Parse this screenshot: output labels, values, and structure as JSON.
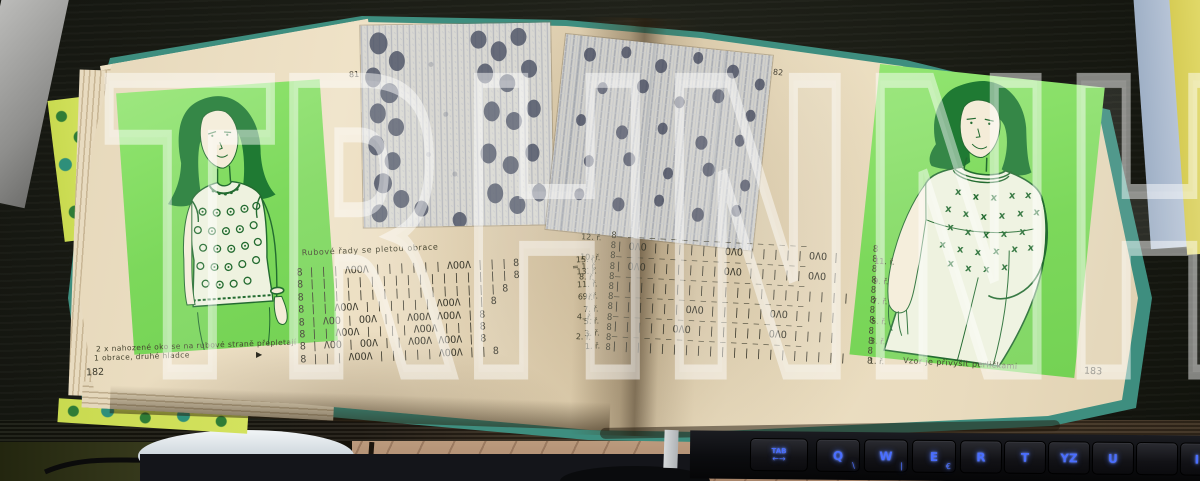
{
  "watermark": {
    "text": "TRHNNH"
  },
  "book": {
    "left_page": {
      "photo_label": "81",
      "chart_note": "Rubové řady se pletou obrace",
      "chart": {
        "rows": [
          {
            "symbols": "8 | | | ΛOOΛ | | | | | | ΛOOΛ | | | 8",
            "label": "15. ř.",
            "label2": "= 1. ř."
          },
          {
            "symbols": "8 | | | | | | | | | | | | | | | | | 8",
            "label": "13. ř."
          },
          {
            "symbols": "8 | | | | | | | | | | | | | | | | 8",
            "label": "11. ř."
          },
          {
            "symbols": "8 | | ΛOOΛ | | | | | | ΛOOΛ | | 8",
            "label": "9. ř."
          },
          {
            "symbols": "8 | ΛOO | OOΛ | | ΛOOΛ ΛOOΛ | 8",
            "label": "7. ř."
          },
          {
            "symbols": "8 | | ΛOOΛ | | | | ΛOOΛ | | | 8",
            "label": "5. ř."
          },
          {
            "symbols": "8 | ΛOO | OOΛ | | ΛOOΛ ΛOOΛ | 8",
            "label": "3. ř."
          },
          {
            "symbols": "8 | | | ΛOOΛ | | | | | ΛOOΛ | | 8",
            "label": "1. ř."
          }
        ]
      },
      "caption_line1": "2 x nahozené oko se na rubové straně přepletají",
      "caption_line2": "1 obrace, druhé hladce",
      "pointer": "▶",
      "page_number": "182"
    },
    "right_page": {
      "photo_label": "82",
      "chart": {
        "edge": "8\n8\n8\n8\n8\n8\n8\n8\n8\n8\n8\n8",
        "rows": [
          {
            "left": "12. ř.",
            "dash": "– – – – – – – – – – – – – – – – – –",
            "symbols": "| OΛO | | | | | | OΛO | | | | | OΛO |",
            "right": "11. ř."
          },
          {
            "left": "10. ř.",
            "dash": "– – – – – – – – – – – – – – – – – –",
            "symbols": "| OΛO | | | | | | OΛO | | | | | OΛO |",
            "right": "9. ř."
          },
          {
            "left": "8. ř.",
            "dash": "– – – – – – – – – – – – – – – – – –",
            "symbols": "| | | | | | | | | | | | | | | | | | | |",
            "right": "7. ř."
          },
          {
            "left": "6. ř.",
            "dash": "– – – – – – – – – – – – – – – – – –",
            "symbols": "| | | | | | OΛO | | | | | OΛO | | | |",
            "right": "5. ř."
          },
          {
            "left": "4. ř.",
            "dash": "– – – – – – – – – – – – – – – – – –",
            "symbols": "| | | | | OΛO | | | | | | OΛO | | | |",
            "right": "3. ř."
          },
          {
            "left": "2. ř.",
            "dash": "– – – – – – – – – – – – – – – – – –",
            "symbols": "| | | | | | | | | | | | | | | | | | | |",
            "right": "1. ř."
          }
        ]
      },
      "caption": "Vzor je přivýšit perličkami",
      "page_number": "183"
    }
  },
  "keyboard": {
    "keys": [
      {
        "label": "TAB",
        "sub": "←→"
      },
      {
        "label": "Q",
        "sub": "\\"
      },
      {
        "label": "W",
        "sub": "|"
      },
      {
        "label": "E",
        "sub": "€"
      },
      {
        "label": "R",
        "sub": ""
      },
      {
        "label": "T",
        "sub": ""
      },
      {
        "label": "YZ",
        "sub": ""
      },
      {
        "label": "U",
        "sub": ""
      },
      {
        "label": "",
        "sub": ""
      },
      {
        "label": "I",
        "sub": ""
      }
    ]
  }
}
